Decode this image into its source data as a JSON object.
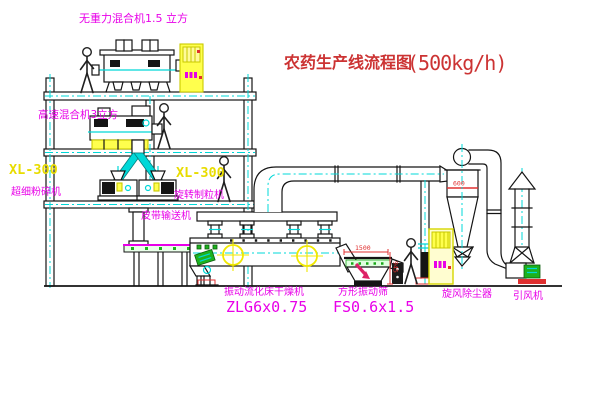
{
  "title": {
    "text": "农药生产线流程图",
    "capacity": "(500kg/h)"
  },
  "labels": {
    "gravity_mixer": "无重力混合机1.5 立方",
    "high_speed_mixer": "高速混合机3立方",
    "mill_model": "XL-300",
    "mill_name": "超细粉碎机",
    "granulator_model": "XL-300",
    "granulator_name": "旋转制粒机",
    "belt_conveyor": "皮带输送机",
    "dryer_name": "振动流化床干燥机",
    "dryer_model": "ZLG6x0.75",
    "sieve_name": "方形振动筛",
    "sieve_model": "FS0.6x1.5",
    "cyclone": "旋风除尘器",
    "fan": "引风机"
  },
  "dimensions": {
    "cyclone_diameter": "600",
    "sieve_length": "1500",
    "sieve_height": "945"
  },
  "colors": {
    "label_magenta": "#e800e8",
    "model_yellow": "#e8dc00",
    "title_red": "#cc3333",
    "dimension_red": "#e03030",
    "line_black": "#141414",
    "centerline_cyan": "#00d8d8",
    "equipment_yellow": "#ffff4d",
    "accent_green": "#1db21d"
  }
}
